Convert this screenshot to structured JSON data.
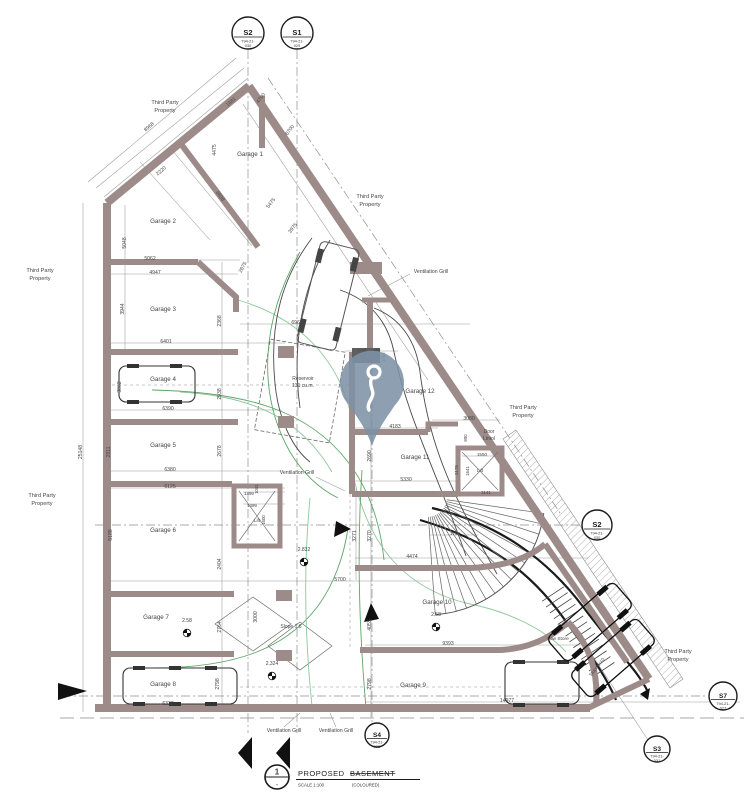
{
  "title": {
    "number": "1",
    "dash": "-",
    "main": "PROPOSED",
    "struck": "BASEMENT",
    "scale": "SCALE 1:100",
    "note": "(COLOURED)"
  },
  "markers": {
    "s2_top": {
      "label": "S2",
      "ref1": "794-21-",
      "ref2": "030"
    },
    "s1_top": {
      "label": "S1",
      "ref1": "794-21-",
      "ref2": "029"
    },
    "s2_right": {
      "label": "S2",
      "ref1": "794-21-",
      "ref2": "030"
    },
    "s7": {
      "label": "S7",
      "ref1": "794-21-",
      "ref2": "027"
    },
    "s3": {
      "label": "S3",
      "ref1": "794-21-",
      "ref2": "031"
    },
    "s4": {
      "label": "S4",
      "ref1": "794-21-",
      "ref2": "032"
    }
  },
  "pin": {
    "name": "location-pin",
    "glyph": "question-hook",
    "color": "#7d92a5"
  },
  "rooms": [
    {
      "t": "Garage 1",
      "x": 250,
      "y": 156
    },
    {
      "t": "Garage 2",
      "x": 163,
      "y": 223
    },
    {
      "t": "Garage 3",
      "x": 163,
      "y": 311
    },
    {
      "t": "Garage 4",
      "x": 163,
      "y": 381
    },
    {
      "t": "Garage 5",
      "x": 163,
      "y": 447
    },
    {
      "t": "Garage 6",
      "x": 163,
      "y": 532
    },
    {
      "t": "Garage 7",
      "x": 156,
      "y": 619
    },
    {
      "t": "Garage 8",
      "x": 163,
      "y": 686
    },
    {
      "t": "Garage 9",
      "x": 413,
      "y": 687
    },
    {
      "t": "Garage 10",
      "x": 437,
      "y": 604
    },
    {
      "t": "Garage 11",
      "x": 415,
      "y": 459
    },
    {
      "t": "Garage 12",
      "x": 420,
      "y": 393
    }
  ],
  "labels": [
    {
      "t": "Third Party",
      "x": 165,
      "y": 104
    },
    {
      "t": "Property",
      "x": 165,
      "y": 112
    },
    {
      "t": "Third Party",
      "x": 370,
      "y": 198
    },
    {
      "t": "Property",
      "x": 370,
      "y": 206
    },
    {
      "t": "Third Party",
      "x": 40,
      "y": 272
    },
    {
      "t": "Property",
      "x": 40,
      "y": 280
    },
    {
      "t": "Third Party",
      "x": 42,
      "y": 497
    },
    {
      "t": "Property",
      "x": 42,
      "y": 505
    },
    {
      "t": "Third Party",
      "x": 523,
      "y": 409
    },
    {
      "t": "Property",
      "x": 523,
      "y": 417
    },
    {
      "t": "Third Party",
      "x": 678,
      "y": 653
    },
    {
      "t": "Property",
      "x": 678,
      "y": 661
    },
    {
      "t": "Ventilation Grill",
      "x": 431,
      "y": 273,
      "s": 5.2
    },
    {
      "t": "Ventilation Grill",
      "x": 297,
      "y": 474,
      "s": 5.2
    },
    {
      "t": "Ventilation Grill",
      "x": 284,
      "y": 732,
      "s": 5.2
    },
    {
      "t": "Ventilation Grill",
      "x": 336,
      "y": 732,
      "s": 5.2
    },
    {
      "t": "Lift",
      "x": 257,
      "y": 522,
      "s": 4.6
    },
    {
      "t": "Lift",
      "x": 480,
      "y": 472,
      "s": 4.6
    },
    {
      "t": "Reservoir",
      "x": 303,
      "y": 380,
      "s": 5
    },
    {
      "t": "131 cu.m.",
      "x": 303,
      "y": 387,
      "s": 5
    },
    {
      "t": "Door",
      "x": 489,
      "y": 433,
      "s": 5
    },
    {
      "t": "Lintol",
      "x": 489,
      "y": 440,
      "s": 5
    },
    {
      "t": "Low Store",
      "x": 558,
      "y": 640,
      "s": 4.8
    },
    {
      "t": "Slope 1:6",
      "x": 291,
      "y": 628,
      "s": 5
    },
    {
      "t": "Slope 1:10",
      "x": 598,
      "y": 668,
      "s": 4.6,
      "r": -52
    }
  ],
  "levels": [
    {
      "t": "2.58",
      "x": 187,
      "y": 622
    },
    {
      "t": "2.58",
      "x": 436,
      "y": 616
    },
    {
      "t": "2.832",
      "x": 304,
      "y": 551
    },
    {
      "t": "2.324",
      "x": 272,
      "y": 665
    }
  ],
  "dims": [
    {
      "t": "4700",
      "x": 262,
      "y": 99,
      "r": -52
    },
    {
      "t": "6700",
      "x": 291,
      "y": 131,
      "r": -52
    },
    {
      "t": "1681",
      "x": 232,
      "y": 103,
      "r": -40
    },
    {
      "t": "8968",
      "x": 150,
      "y": 128,
      "r": -40
    },
    {
      "t": "2220",
      "x": 162,
      "y": 172,
      "r": -40
    },
    {
      "t": "6898",
      "x": 219,
      "y": 197,
      "r": 53
    },
    {
      "t": "5475",
      "x": 272,
      "y": 204,
      "r": -52
    },
    {
      "t": "3975",
      "x": 294,
      "y": 229,
      "r": -52
    },
    {
      "t": "2675",
      "x": 244,
      "y": 268,
      "r": -62
    },
    {
      "t": "4475",
      "x": 216,
      "y": 150,
      "r": -90
    },
    {
      "t": "5062",
      "x": 150,
      "y": 260
    },
    {
      "t": "4947",
      "x": 155,
      "y": 274
    },
    {
      "t": "6401",
      "x": 166,
      "y": 343
    },
    {
      "t": "6390",
      "x": 168,
      "y": 410
    },
    {
      "t": "6380",
      "x": 170,
      "y": 471
    },
    {
      "t": "6125",
      "x": 170,
      "y": 488
    },
    {
      "t": "5700",
      "x": 340,
      "y": 581
    },
    {
      "t": "6322",
      "x": 168,
      "y": 705
    },
    {
      "t": "25148",
      "x": 82,
      "y": 452,
      "r": -90
    },
    {
      "t": "5048",
      "x": 126,
      "y": 243,
      "r": -90
    },
    {
      "t": "3944",
      "x": 124,
      "y": 309,
      "r": -90
    },
    {
      "t": "3062",
      "x": 121,
      "y": 387,
      "r": -90
    },
    {
      "t": "2811",
      "x": 110,
      "y": 452,
      "r": -90
    },
    {
      "t": "5188",
      "x": 112,
      "y": 535,
      "r": -90
    },
    {
      "t": "2368",
      "x": 221,
      "y": 321,
      "r": -90
    },
    {
      "t": "2938",
      "x": 221,
      "y": 394,
      "r": -90
    },
    {
      "t": "2678",
      "x": 221,
      "y": 451,
      "r": -90
    },
    {
      "t": "2404",
      "x": 221,
      "y": 564,
      "r": -90
    },
    {
      "t": "2764",
      "x": 221,
      "y": 627,
      "r": -90
    },
    {
      "t": "2798",
      "x": 219,
      "y": 684,
      "r": -90
    },
    {
      "t": "1499",
      "x": 249,
      "y": 495,
      "s": 4.4
    },
    {
      "t": "1499",
      "x": 252,
      "y": 507,
      "s": 4.4
    },
    {
      "t": "1600",
      "x": 265,
      "y": 520,
      "r": -90,
      "s": 4.4
    },
    {
      "t": "1081",
      "x": 258,
      "y": 489,
      "r": -90,
      "s": 4.4
    },
    {
      "t": "6965",
      "x": 297,
      "y": 324
    },
    {
      "t": "3000",
      "x": 257,
      "y": 617,
      "r": -90
    },
    {
      "t": "1248",
      "x": 362,
      "y": 351,
      "s": 4
    },
    {
      "t": "885",
      "x": 377,
      "y": 351,
      "s": 4
    },
    {
      "t": "1785",
      "x": 385,
      "y": 357,
      "r": -90,
      "s": 4
    },
    {
      "t": "2690",
      "x": 371,
      "y": 456,
      "r": -90
    },
    {
      "t": "3271",
      "x": 356,
      "y": 536,
      "r": -90
    },
    {
      "t": "3270",
      "x": 371,
      "y": 536,
      "r": -90
    },
    {
      "t": "4055",
      "x": 371,
      "y": 625,
      "r": -90
    },
    {
      "t": "2798",
      "x": 371,
      "y": 684,
      "r": -90
    },
    {
      "t": "4183",
      "x": 395,
      "y": 428
    },
    {
      "t": "3080",
      "x": 469,
      "y": 420
    },
    {
      "t": "890",
      "x": 467,
      "y": 438,
      "r": -90,
      "s": 4.4
    },
    {
      "t": "1550",
      "x": 482,
      "y": 456,
      "s": 4.6
    },
    {
      "t": "2175",
      "x": 458,
      "y": 470,
      "r": -90,
      "s": 4.4
    },
    {
      "t": "1641",
      "x": 469,
      "y": 471,
      "r": -90,
      "s": 4.4
    },
    {
      "t": "5330",
      "x": 406,
      "y": 481
    },
    {
      "t": "1141",
      "x": 486,
      "y": 494,
      "s": 4.6
    },
    {
      "t": "1750",
      "x": 455,
      "y": 535,
      "s": 4.6
    },
    {
      "t": "4474",
      "x": 412,
      "y": 558
    },
    {
      "t": "9393",
      "x": 448,
      "y": 645
    },
    {
      "t": "14977",
      "x": 507,
      "y": 702
    }
  ]
}
